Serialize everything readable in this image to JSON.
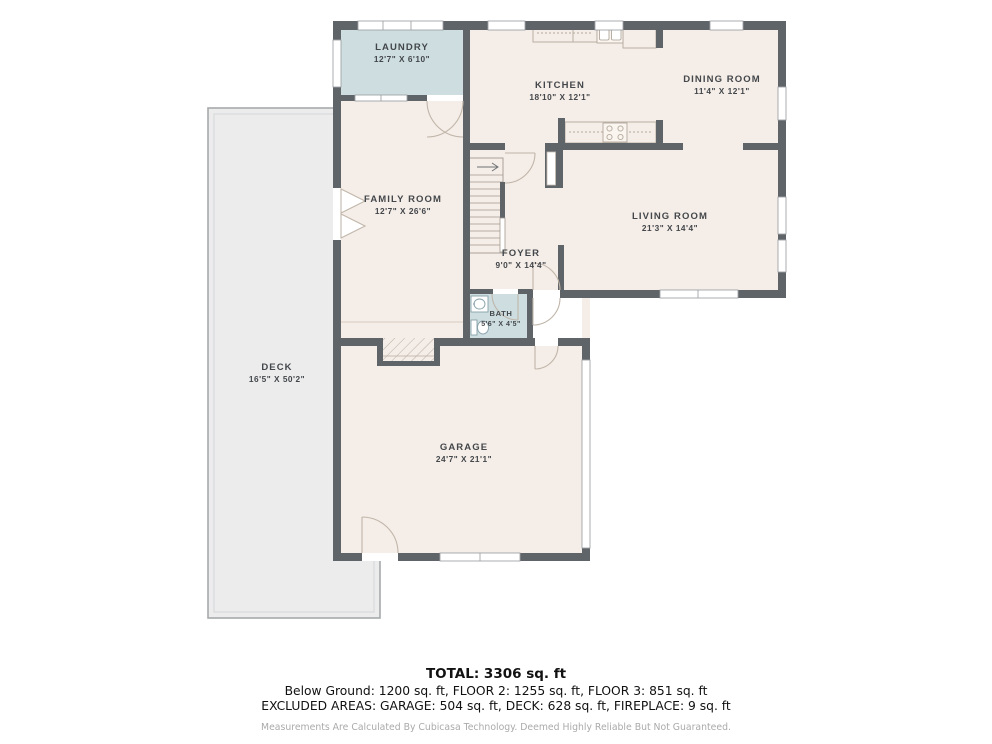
{
  "plan": {
    "type": "floor-plan",
    "colors": {
      "wall": "#5f6468",
      "floor": "#f5ede7",
      "wet_room": "#cddde0",
      "deck": "#ececec",
      "label": "#43474b"
    },
    "rooms": {
      "laundry": {
        "name": "LAUNDRY",
        "dims": "12'7\" X 6'10\""
      },
      "kitchen": {
        "name": "KITCHEN",
        "dims": "18'10\" X 12'1\""
      },
      "dining": {
        "name": "DINING ROOM",
        "dims": "11'4\" X 12'1\""
      },
      "family": {
        "name": "FAMILY ROOM",
        "dims": "12'7\" X 26'6\""
      },
      "living": {
        "name": "LIVING ROOM",
        "dims": "21'3\" X 14'4\""
      },
      "foyer": {
        "name": "FOYER",
        "dims": "9'0\" X 14'4\""
      },
      "bath": {
        "name": "BATH",
        "dims": "5'6\" X 4'5\""
      },
      "garage": {
        "name": "GARAGE",
        "dims": "24'7\" X 21'1\""
      },
      "deck": {
        "name": "DECK",
        "dims": "16'5\" X 50'2\""
      }
    }
  },
  "footer": {
    "total": "TOTAL: 3306 sq. ft",
    "floors": "Below Ground: 1200 sq. ft, FLOOR 2: 1255 sq. ft, FLOOR 3: 851 sq. ft",
    "excluded": "EXCLUDED AREAS: GARAGE: 504 sq. ft, DECK: 628 sq. ft, FIREPLACE: 9 sq. ft",
    "disclaimer": "Measurements Are Calculated By Cubicasa Technology. Deemed Highly Reliable But Not Guaranteed."
  }
}
